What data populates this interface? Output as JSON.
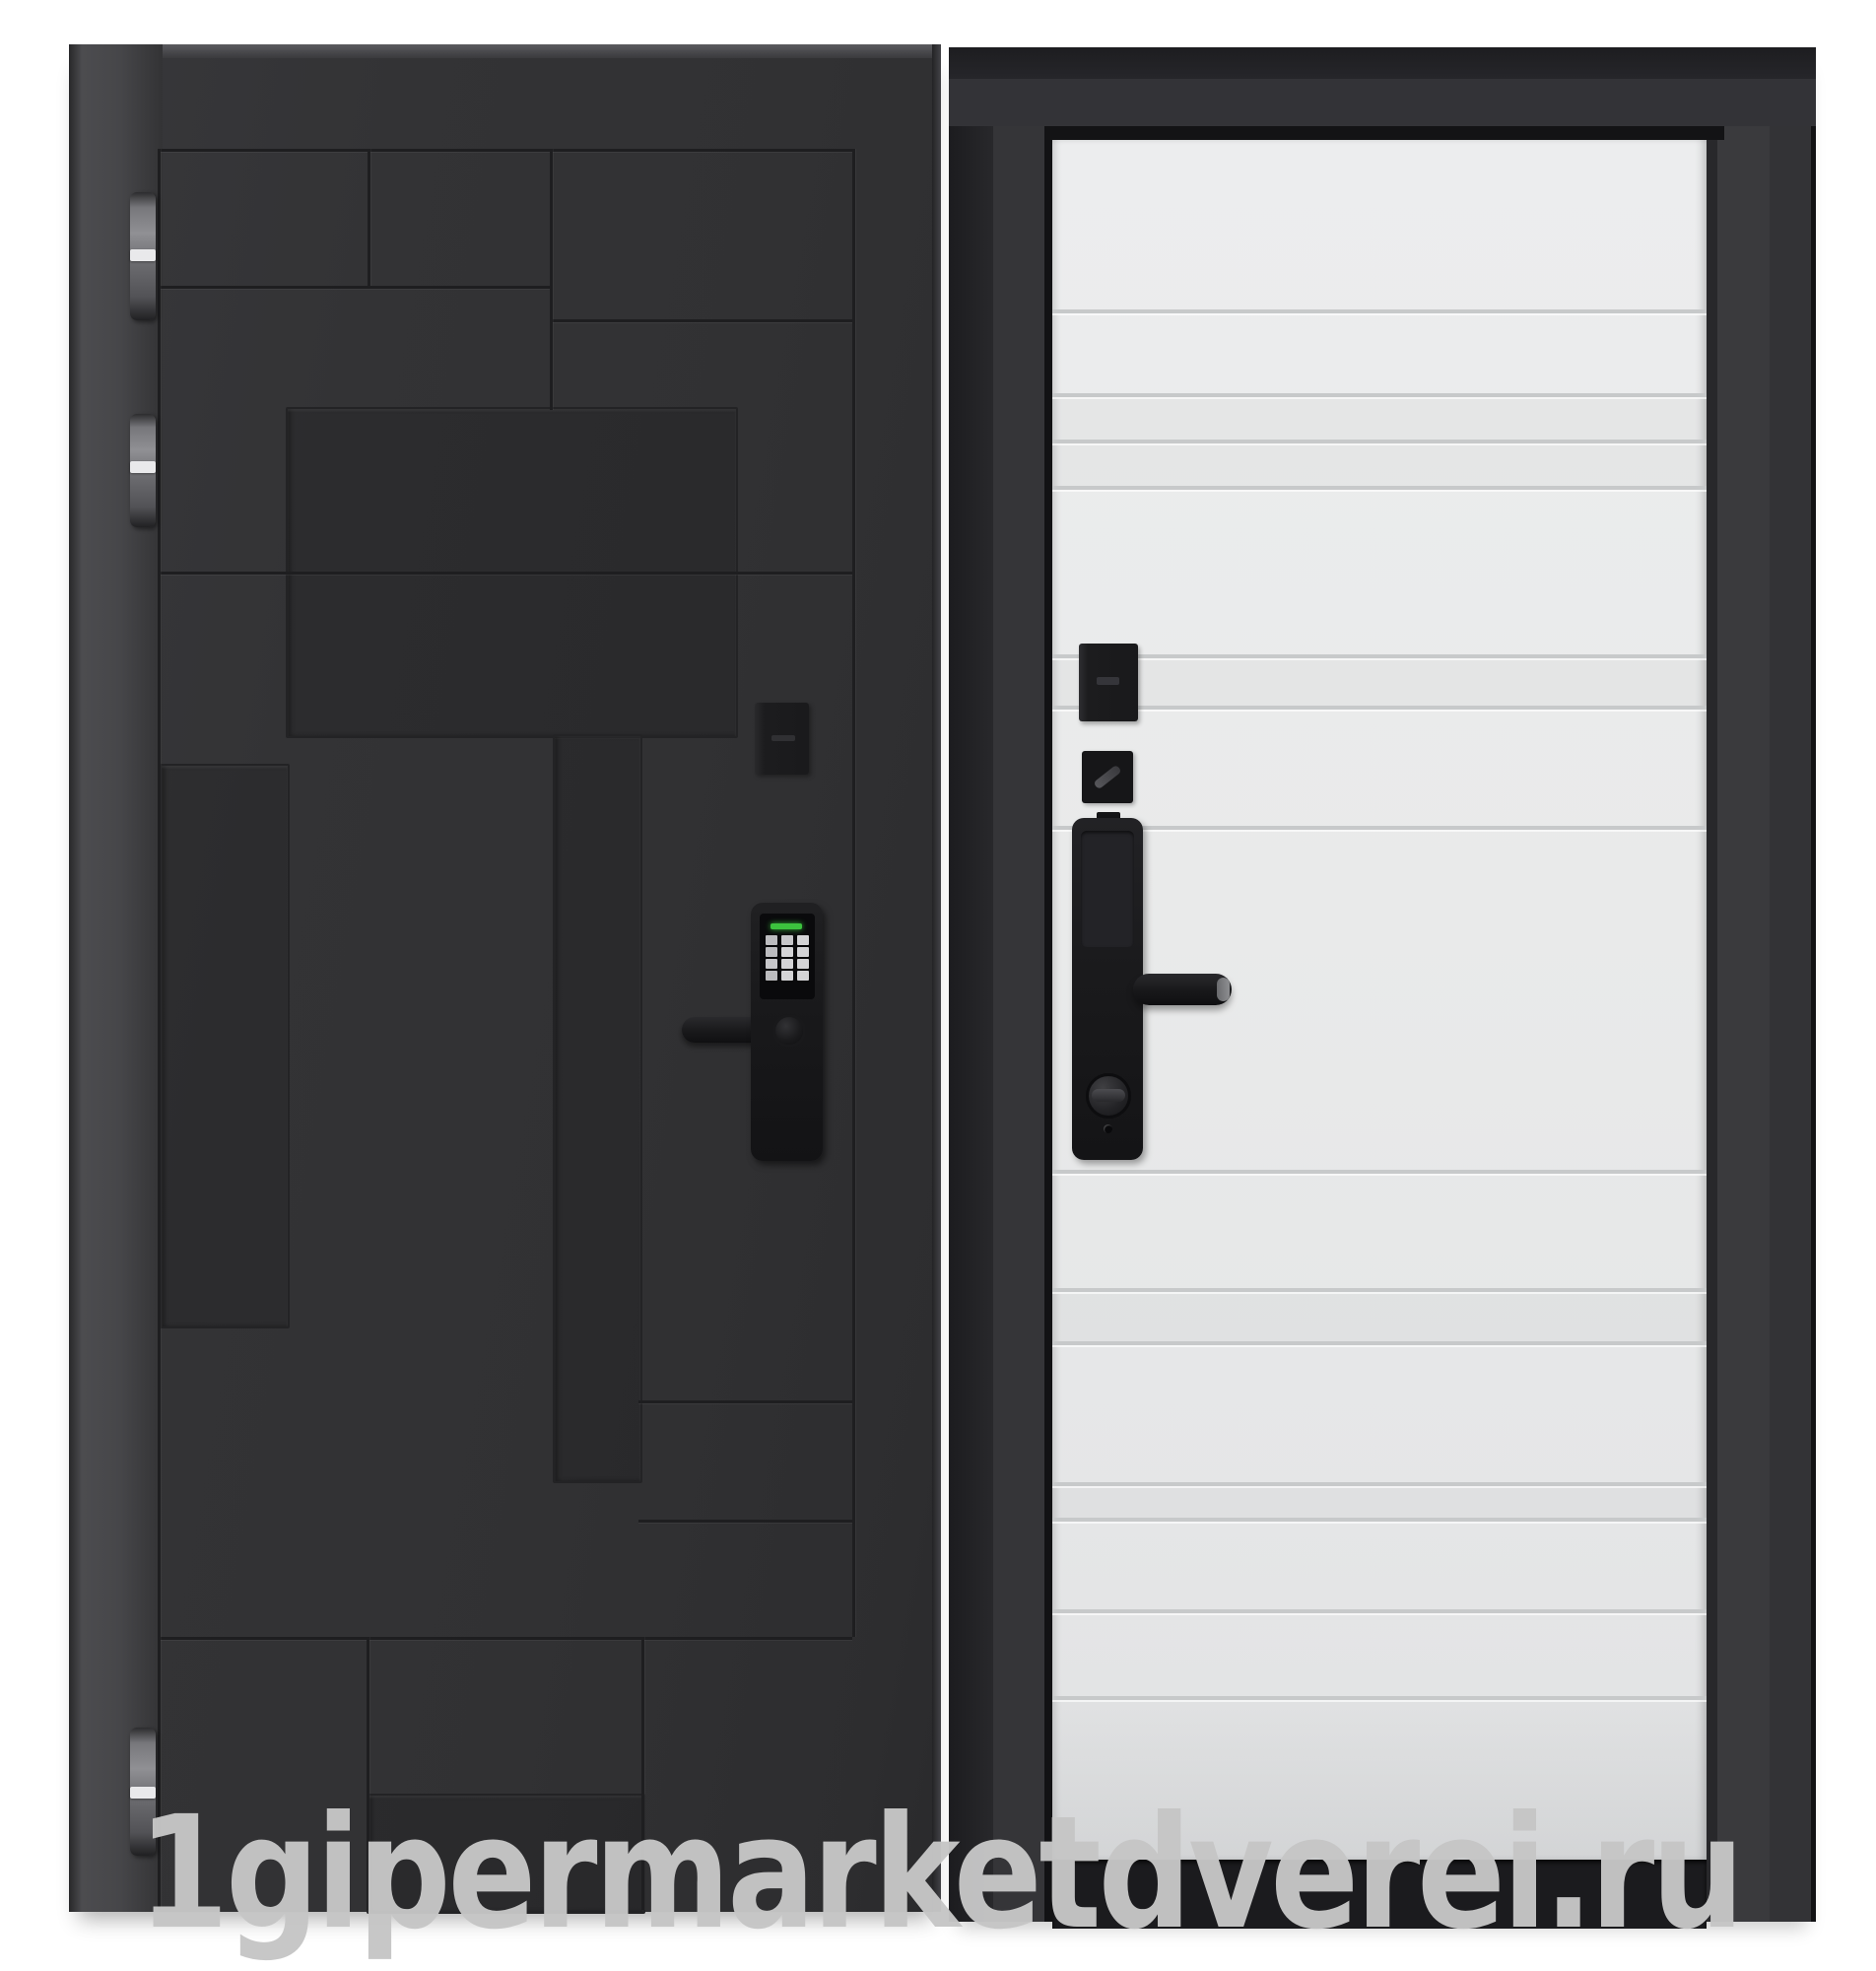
{
  "page": {
    "background": "#ffffff"
  },
  "watermark": {
    "text": "1gipermarketdverei.ru",
    "color": "#c6c6c6"
  },
  "product": {
    "type": "entry-door-product-photo",
    "views": 2,
    "exterior_side": {
      "leaf_color": "#323234",
      "groove_color": "#1e1e20",
      "hinge_count": 3,
      "hinge_metal_color": "#8e8e92",
      "card_reader_color": "#1c1c1e",
      "smart_lock": {
        "body_color": "#19191b",
        "screen_color": "#0a0a0c",
        "status_led_color": "#3cc33e",
        "keypad_rows": 4,
        "keypad_columns": 3,
        "key_color": "#d4d4d6"
      }
    },
    "interior_side": {
      "frame_color": "#2b2b2e",
      "leaf_color": "#e9eaea",
      "groove_color": "#c7c9ca",
      "groove_count": 14,
      "hardware_color": "#1a1a1c",
      "threshold_color": "#1b1b1e"
    }
  }
}
